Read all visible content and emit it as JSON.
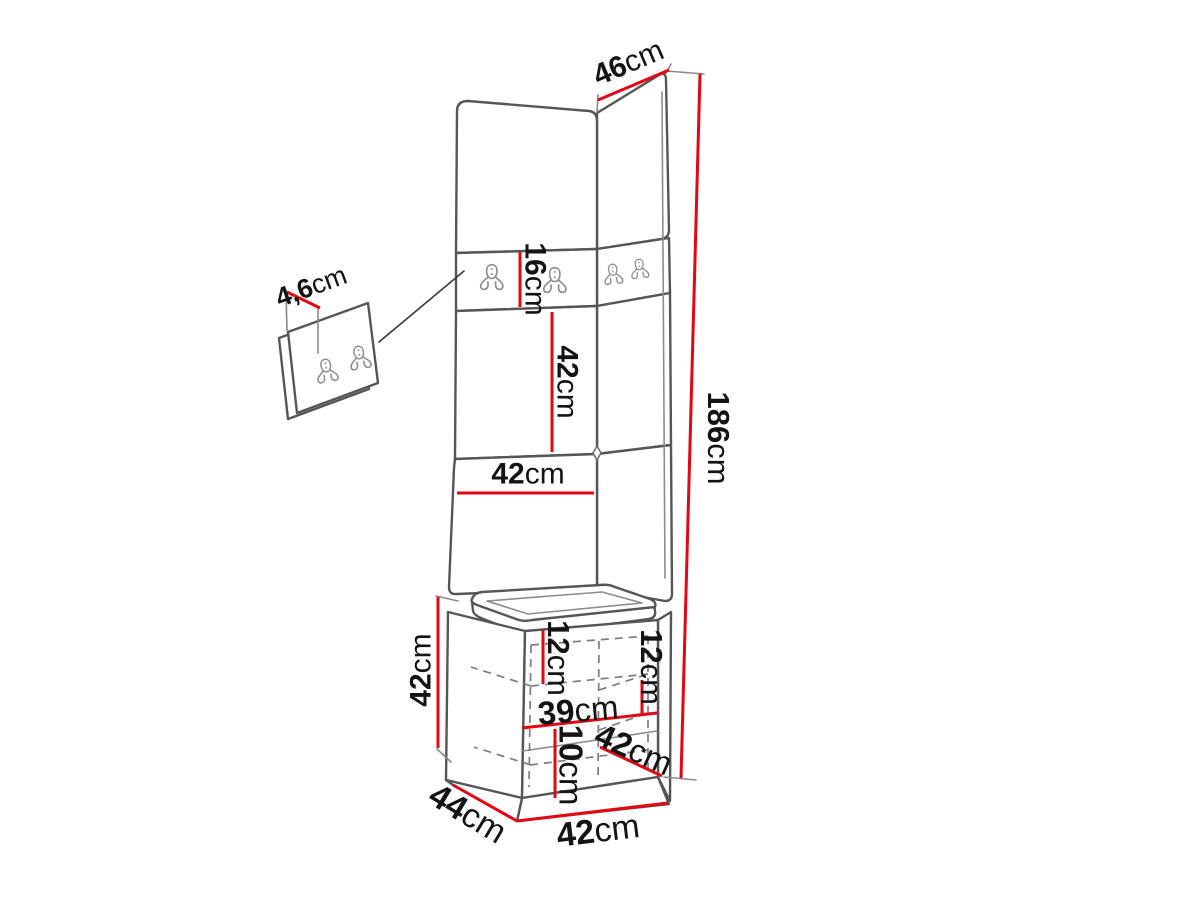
{
  "diagram": {
    "description": "Hallway furniture set dimension drawing: tall corner upholstered panel with coat hooks, detail view of hook panel, seat cushion and storage cabinet",
    "colors": {
      "dimension_red": "#e30613",
      "outline_gray": "#565656",
      "background": "#ffffff",
      "text": "#141414"
    },
    "icons": {
      "hook": "double-coat-hook-icon"
    },
    "dimensions": [
      {
        "id": "corner-panel-top-width",
        "value": "46",
        "unit": "cm"
      },
      {
        "id": "hook-panel-thickness",
        "value": "4,6",
        "unit": "cm"
      },
      {
        "id": "hook-strip-height",
        "value": "16",
        "unit": "cm"
      },
      {
        "id": "panel-section-height",
        "value": "42",
        "unit": "cm"
      },
      {
        "id": "front-panel-width",
        "value": "42",
        "unit": "cm"
      },
      {
        "id": "total-height",
        "value": "186",
        "unit": "cm"
      },
      {
        "id": "cabinet-height",
        "value": "42",
        "unit": "cm"
      },
      {
        "id": "shelf-gap-left",
        "value": "12",
        "unit": "cm"
      },
      {
        "id": "shelf-gap-right",
        "value": "12",
        "unit": "cm"
      },
      {
        "id": "inner-width",
        "value": "39",
        "unit": "cm"
      },
      {
        "id": "bottom-gap-height",
        "value": "10",
        "unit": "cm"
      },
      {
        "id": "lower-section-depth",
        "value": "42",
        "unit": "cm"
      },
      {
        "id": "base-depth",
        "value": "44",
        "unit": "cm"
      },
      {
        "id": "base-width",
        "value": "42",
        "unit": "cm"
      }
    ]
  }
}
